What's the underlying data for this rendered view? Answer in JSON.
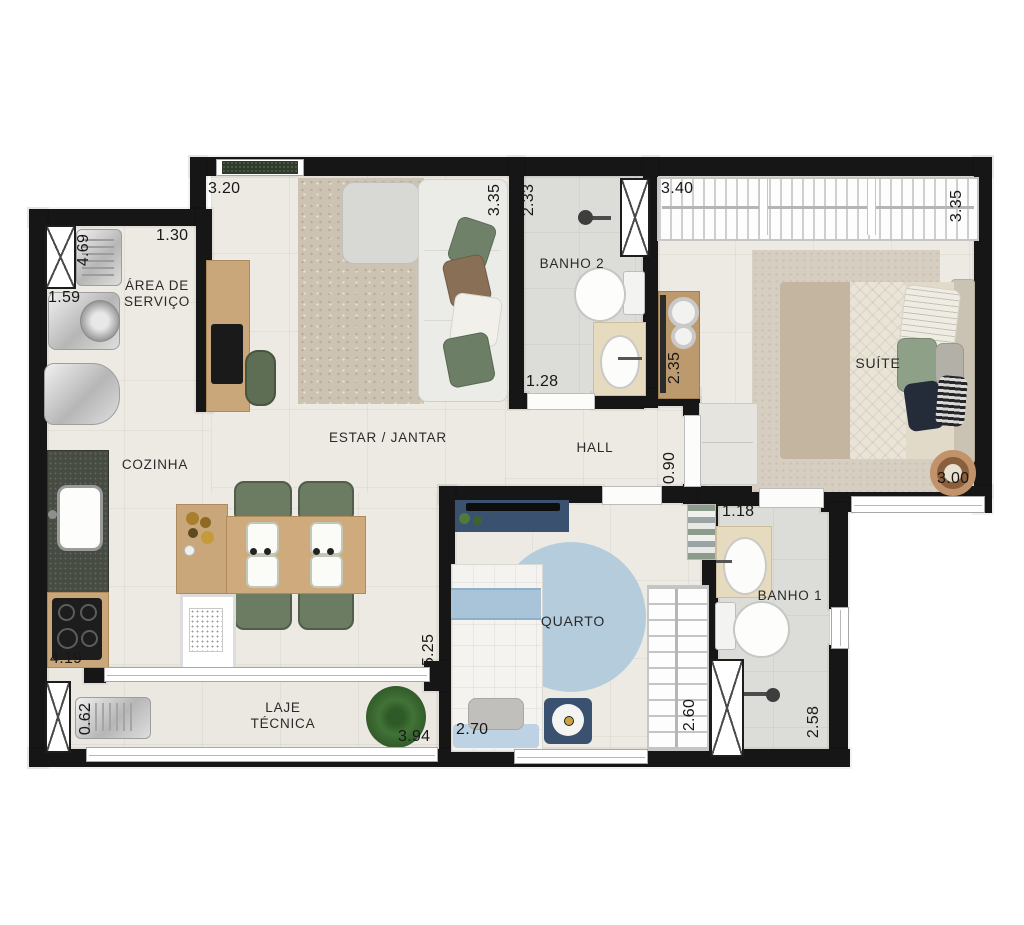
{
  "plan": {
    "type": "apartment-floor-plan",
    "rooms": {
      "area_servico": "ÁREA DE SERVIÇO",
      "cozinha": "COZINHA",
      "estar_jantar": "ESTAR / JANTAR",
      "hall": "HALL",
      "banho2": "BANHO 2",
      "suite": "SUÍTE",
      "quarto": "QUARTO",
      "banho1": "BANHO 1",
      "laje_tecnica": "LAJE TÉCNICA"
    },
    "dimensions": {
      "estar_top_width": "3.20",
      "servico_width": "1.30",
      "servico_left_height": "4.69",
      "servico_left_width": "1.59",
      "estar_right_height": "3.35",
      "banho2_height": "2.33",
      "banho2_door_width": "1.28",
      "suite_closet_width": "3.40",
      "suite_right_height": "3.35",
      "suite_sideboard_height": "2.35",
      "hall_door_height": "0.90",
      "suite_bottom_width": "3.00",
      "banho1_top_width": "1.18",
      "banho1_right_height": "2.58",
      "quarto_closet_height": "2.60",
      "quarto_bottom_width": "2.70",
      "quarto_left_height": "5.25",
      "cozinha_left_height": "4.19",
      "laje_left_height": "0.62",
      "laje_bottom_width": "3.94"
    },
    "colors": {
      "wall": "#161616",
      "floor": "#edeae3",
      "bath_floor": "#dcddd9",
      "wood": "#c9a77a",
      "chair_green": "#6b7c62",
      "kid_blue": "#3a5170",
      "kid_rug_blue": "#b5ccdc",
      "counter_granite": "#474c42"
    }
  }
}
